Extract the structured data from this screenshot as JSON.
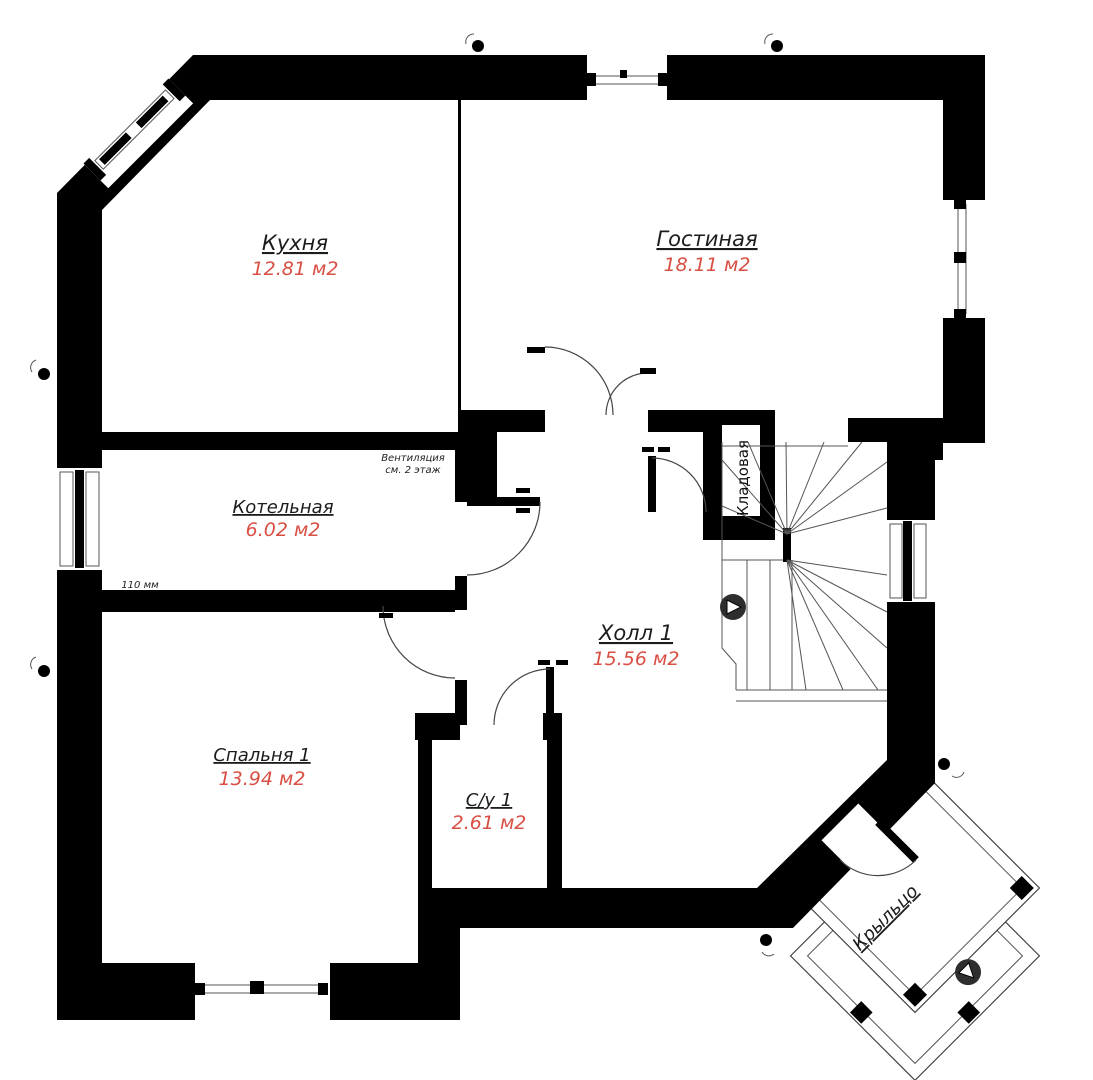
{
  "plan": {
    "rooms": [
      {
        "id": "kitchen",
        "name": "Кухня",
        "area": "12.81 м2"
      },
      {
        "id": "living",
        "name": "Гостиная",
        "area": "18.11 м2"
      },
      {
        "id": "boiler",
        "name": "Котельная",
        "area": "6.02 м2"
      },
      {
        "id": "hall",
        "name": "Холл 1",
        "area": "15.56 м2"
      },
      {
        "id": "bedroom",
        "name": "Спальня 1",
        "area": "13.94 м2"
      },
      {
        "id": "bathroom",
        "name": "С/у 1",
        "area": "2.61 м2"
      },
      {
        "id": "storage",
        "name": "Кладовая",
        "area": ""
      },
      {
        "id": "porch",
        "name": "Крыльцо",
        "area": ""
      }
    ],
    "annotations": {
      "ventilation_line1": "Вентиляция",
      "ventilation_line2": "см. 2 этаж",
      "wall_thickness": "110 мм"
    },
    "colors": {
      "wall": "#000000",
      "background": "#ffffff",
      "area_text": "#d94f44",
      "label_text": "#1c1c1c"
    }
  }
}
